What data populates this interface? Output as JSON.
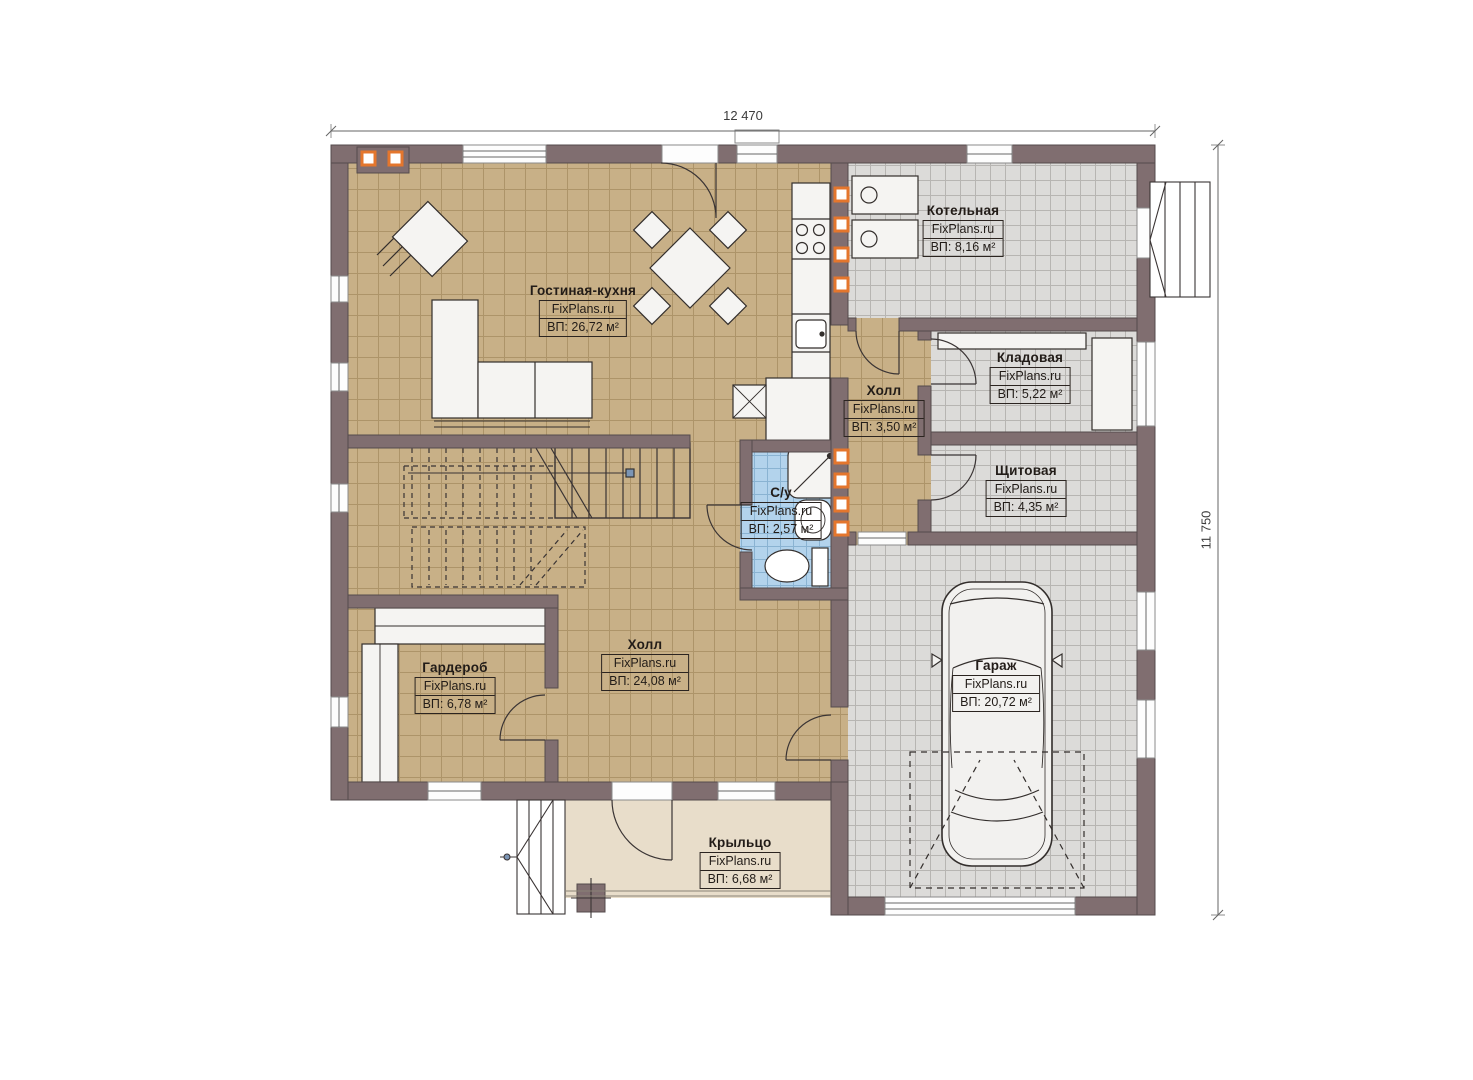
{
  "brand": "FixPlans.ru",
  "dimensions": {
    "width_label": "12 470",
    "height_label": "11 750"
  },
  "rooms": [
    {
      "id": "living-kitchen",
      "name": "Гостиная-кухня",
      "brand": "FixPlans.ru",
      "area": "ВП: 26,72 м²"
    },
    {
      "id": "boiler",
      "name": "Котельная",
      "brand": "FixPlans.ru",
      "area": "ВП: 8,16 м²"
    },
    {
      "id": "storage",
      "name": "Кладовая",
      "brand": "FixPlans.ru",
      "area": "ВП: 5,22 м²"
    },
    {
      "id": "hall-small",
      "name": "Холл",
      "brand": "FixPlans.ru",
      "area": "ВП: 3,50 м²"
    },
    {
      "id": "switchboard",
      "name": "Щитовая",
      "brand": "FixPlans.ru",
      "area": "ВП: 4,35 м²"
    },
    {
      "id": "bathroom",
      "name": "С/у",
      "brand": "FixPlans.ru",
      "area": "ВП: 2,57 м²"
    },
    {
      "id": "hall-big",
      "name": "Холл",
      "brand": "FixPlans.ru",
      "area": "ВП: 24,08 м²"
    },
    {
      "id": "wardrobe",
      "name": "Гардероб",
      "brand": "FixPlans.ru",
      "area": "ВП: 6,78 м²"
    },
    {
      "id": "garage",
      "name": "Гараж",
      "brand": "FixPlans.ru",
      "area": "ВП: 20,72 м²"
    },
    {
      "id": "porch",
      "name": "Крыльцо",
      "brand": "FixPlans.ru",
      "area": "ВП: 6,68 м²"
    }
  ],
  "palette": {
    "wall": "#806E70",
    "floor_tan": "#C8B087",
    "floor_gray": "#DCDBD9",
    "floor_blue": "#B3D3EC",
    "floor_porch": "#E8DDCA",
    "register_orange": "#E4762D",
    "line": "#3A3434"
  }
}
